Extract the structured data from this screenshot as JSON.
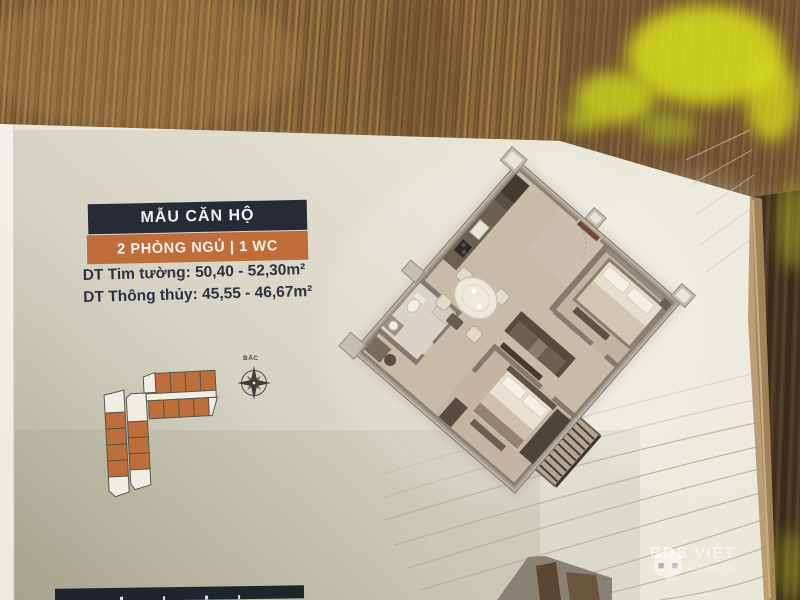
{
  "photo": {
    "header": {
      "title": "MẪU CĂN HỘ",
      "subtitle": "2 PHÒNG NGỦ | 1 WC"
    },
    "areas": {
      "line1": {
        "label": "DT Tim tường:",
        "value": "50,40 - 52,30m²"
      },
      "line2": {
        "label": "DT Thông thủy:",
        "value": "45,55 - 46,67m²"
      }
    },
    "compass": {
      "north_label": "BẮC"
    },
    "watermark": {
      "brand": "BDS VIỆT",
      "tagline": "Đăng tin không cần đăng nhập"
    },
    "icons": [
      "compass-rose-icon",
      "bdsviet-cube-logo-icon"
    ],
    "colors": {
      "header_navy": "#262b36",
      "accent_orange": "#bf6d3a",
      "paper": "#eae7db",
      "wood": "#8a6538",
      "highlight_yellow": "#d8de1e"
    }
  }
}
